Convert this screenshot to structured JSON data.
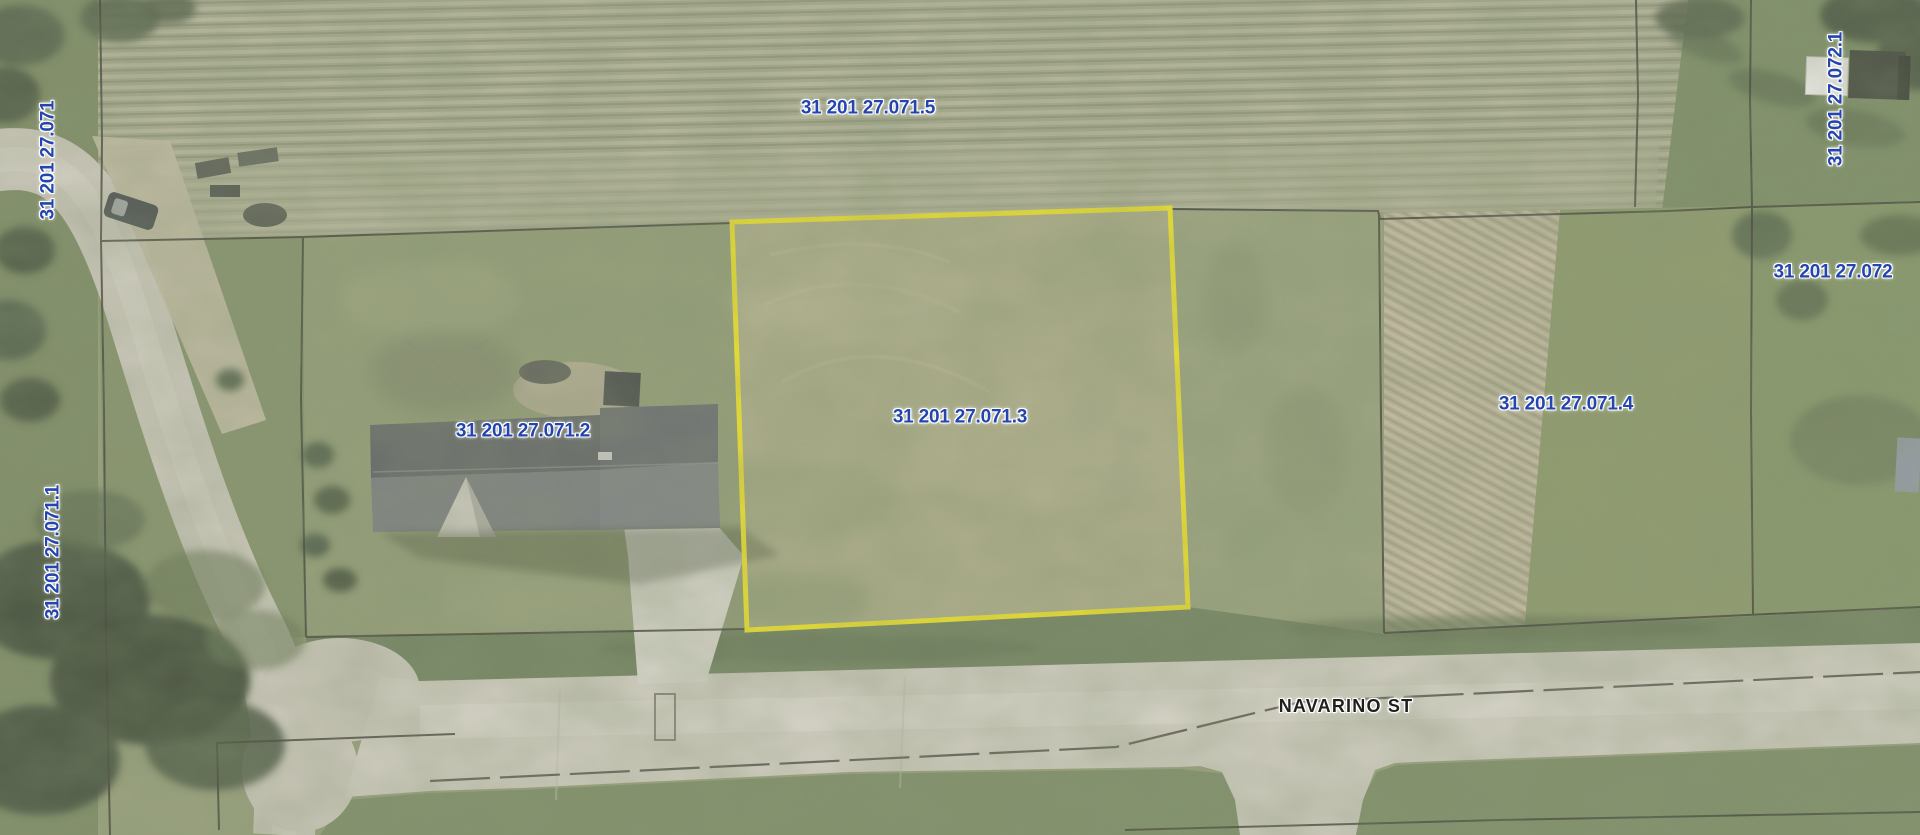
{
  "map": {
    "description": "aerial-parcel-imagery",
    "highlighted_parcel": "31 201 27.071.3"
  },
  "parcel_labels": [
    {
      "text": "31 201 27.071.5",
      "orientation": "horizontal"
    },
    {
      "text": "31 201 27.072.1",
      "orientation": "vertical"
    },
    {
      "text": "31 201 27.071",
      "orientation": "vertical"
    },
    {
      "text": "31 201 27.072",
      "orientation": "horizontal"
    },
    {
      "text": "31 201 27.071.4",
      "orientation": "horizontal"
    },
    {
      "text": "31 201 27.071.3",
      "orientation": "horizontal"
    },
    {
      "text": "31 201 27.071.2",
      "orientation": "horizontal"
    },
    {
      "text": "31 201 27.071.1",
      "orientation": "vertical"
    }
  ],
  "street": {
    "name": "NAVARINO ST"
  },
  "colors": {
    "highlight_outline": "#f0e414",
    "parcel_label": "#2444ae",
    "street_label": "#1f1f1c",
    "boundary_line": "#2f2f26"
  }
}
